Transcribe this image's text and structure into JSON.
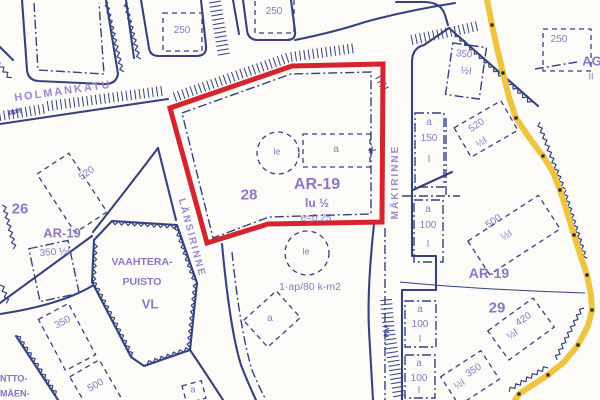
{
  "map": {
    "description": "Finnish detail-plan (asemakaava) map excerpt with a red-outlined plot",
    "colors": {
      "line_blue": "#35427f",
      "label_violet": "#8a79c5",
      "red_boundary": "#d5242d",
      "yellow_line": "#efc53f",
      "background": "#fcfbf8"
    },
    "highlighted_plot": {
      "zone_code": "AR-19",
      "plot_number": "28",
      "storeys": "lu ½",
      "efficiency": "e=0.25"
    }
  },
  "labels": [
    {
      "name": "street-holmankatu",
      "text": "HOLMANKATU",
      "x": 63,
      "y": 92,
      "size": 11,
      "rot": -8,
      "cls": "street"
    },
    {
      "name": "strip-ppt-left",
      "text": "pp/t",
      "x": 15,
      "y": 112,
      "size": 7,
      "rot": -8,
      "cls": "strip"
    },
    {
      "name": "num-250-topleft",
      "text": "250",
      "x": 182,
      "y": 31,
      "size": 10,
      "rot": 0,
      "cls": ""
    },
    {
      "name": "num-250-topcenter",
      "text": "250",
      "x": 274,
      "y": 12,
      "size": 10,
      "rot": 0,
      "cls": ""
    },
    {
      "name": "num-250-topright",
      "text": "250",
      "x": 559,
      "y": 40,
      "size": 10,
      "rot": 0,
      "cls": ""
    },
    {
      "name": "zone-ag",
      "text": "AG",
      "x": 592,
      "y": 61,
      "size": 13,
      "rot": 0,
      "cls": "zone"
    },
    {
      "name": "zone-ag-ii",
      "text": "II",
      "x": 591,
      "y": 77,
      "size": 9,
      "rot": 0,
      "cls": ""
    },
    {
      "name": "num-350-topright",
      "text": "350",
      "x": 464,
      "y": 55,
      "size": 10,
      "rot": 6,
      "cls": ""
    },
    {
      "name": "num-350-topright-half",
      "text": "½I",
      "x": 466,
      "y": 72,
      "size": 10,
      "rot": 6,
      "cls": ""
    },
    {
      "name": "num-520-right",
      "text": "520",
      "x": 477,
      "y": 126,
      "size": 10,
      "rot": -34,
      "cls": ""
    },
    {
      "name": "num-520-right-half",
      "text": "½I",
      "x": 482,
      "y": 143,
      "size": 10,
      "rot": -34,
      "cls": ""
    },
    {
      "name": "box-a150-a",
      "text": "a",
      "x": 429,
      "y": 123,
      "size": 10,
      "rot": 0,
      "cls": ""
    },
    {
      "name": "box-a150-num",
      "text": "150",
      "x": 429,
      "y": 139,
      "size": 10,
      "rot": 0,
      "cls": ""
    },
    {
      "name": "box-a150-i",
      "text": "I",
      "x": 429,
      "y": 160,
      "size": 10,
      "rot": 0,
      "cls": ""
    },
    {
      "name": "box-a100a-a",
      "text": "a",
      "x": 428,
      "y": 210,
      "size": 10,
      "rot": 0,
      "cls": ""
    },
    {
      "name": "box-a100a-num",
      "text": "100",
      "x": 428,
      "y": 226,
      "size": 10,
      "rot": 0,
      "cls": ""
    },
    {
      "name": "box-a100a-i",
      "text": "I",
      "x": 428,
      "y": 245,
      "size": 10,
      "rot": 0,
      "cls": ""
    },
    {
      "name": "box-a100b-a",
      "text": "a",
      "x": 420,
      "y": 310,
      "size": 10,
      "rot": 0,
      "cls": ""
    },
    {
      "name": "box-a100b-num",
      "text": "100",
      "x": 420,
      "y": 325,
      "size": 10,
      "rot": 0,
      "cls": ""
    },
    {
      "name": "box-a100b-i",
      "text": "I",
      "x": 420,
      "y": 340,
      "size": 10,
      "rot": 0,
      "cls": ""
    },
    {
      "name": "box-a100c-a",
      "text": "a",
      "x": 419,
      "y": 364,
      "size": 10,
      "rot": 0,
      "cls": ""
    },
    {
      "name": "box-a100c-num",
      "text": "100",
      "x": 419,
      "y": 379,
      "size": 10,
      "rot": 0,
      "cls": ""
    },
    {
      "name": "box-a100c-i",
      "text": "I",
      "x": 419,
      "y": 391,
      "size": 10,
      "rot": 0,
      "cls": ""
    },
    {
      "name": "num-500-right",
      "text": "500",
      "x": 494,
      "y": 222,
      "size": 10,
      "rot": -33,
      "cls": ""
    },
    {
      "name": "num-500-right-half",
      "text": "½I",
      "x": 507,
      "y": 236,
      "size": 10,
      "rot": -33,
      "cls": ""
    },
    {
      "name": "zone-ar19-right",
      "text": "AR-19",
      "x": 489,
      "y": 273,
      "size": 14,
      "rot": 0,
      "cls": "zone"
    },
    {
      "name": "plot-29",
      "text": "29",
      "x": 497,
      "y": 308,
      "size": 15,
      "rot": 0,
      "cls": "zone"
    },
    {
      "name": "num-420",
      "text": "420",
      "x": 524,
      "y": 320,
      "size": 10,
      "rot": -35,
      "cls": ""
    },
    {
      "name": "num-420-half",
      "text": "½I",
      "x": 513,
      "y": 335,
      "size": 10,
      "rot": -35,
      "cls": ""
    },
    {
      "name": "num-350-botright",
      "text": "350",
      "x": 474,
      "y": 371,
      "size": 10,
      "rot": -33,
      "cls": ""
    },
    {
      "name": "num-350-botright-half",
      "text": "½I",
      "x": 460,
      "y": 385,
      "size": 10,
      "rot": -33,
      "cls": ""
    },
    {
      "name": "street-makirinne",
      "text": "MÄKIRINNE",
      "x": 396,
      "y": 182,
      "size": 10,
      "rot": -90,
      "cls": "street"
    },
    {
      "name": "street-lansirinne",
      "text": "LÄNSIRINNE",
      "x": 191,
      "y": 238,
      "size": 10,
      "rot": 75,
      "cls": "street"
    },
    {
      "name": "zone-ar19-red",
      "text": "AR-19",
      "x": 317,
      "y": 185,
      "size": 16,
      "rot": 0,
      "cls": "zone"
    },
    {
      "name": "storeys-lu",
      "text": "lu  ½",
      "x": 317,
      "y": 203,
      "size": 12,
      "rot": 0,
      "cls": "zone"
    },
    {
      "name": "efficiency",
      "text": "e=0.25",
      "x": 316,
      "y": 219,
      "size": 10,
      "rot": 0,
      "cls": ""
    },
    {
      "name": "plot-28",
      "text": "28",
      "x": 249,
      "y": 195,
      "size": 15,
      "rot": 0,
      "cls": "zone"
    },
    {
      "name": "le-red-parcel",
      "text": "le",
      "x": 277,
      "y": 152,
      "size": 9,
      "rot": 0,
      "cls": ""
    },
    {
      "name": "a-red-parcel",
      "text": "a",
      "x": 336,
      "y": 150,
      "size": 10,
      "rot": 0,
      "cls": ""
    },
    {
      "name": "le-lower-parcel",
      "text": "le",
      "x": 306,
      "y": 252,
      "size": 9,
      "rot": 0,
      "cls": ""
    },
    {
      "name": "apartment-rule",
      "text": "1·ap/80 k-m2",
      "x": 310,
      "y": 287,
      "size": 10.5,
      "rot": 0,
      "cls": ""
    },
    {
      "name": "a-lower-parcel",
      "text": "a",
      "x": 270,
      "y": 319,
      "size": 10,
      "rot": -8,
      "cls": ""
    },
    {
      "name": "strip-ppt-right",
      "text": "pp/t",
      "x": 387,
      "y": 331,
      "size": 7,
      "rot": -78,
      "cls": "strip"
    },
    {
      "name": "plot-26",
      "text": "26",
      "x": 20,
      "y": 209,
      "size": 15,
      "rot": 0,
      "cls": "zone"
    },
    {
      "name": "zone-ar19-left",
      "text": "AR-19",
      "x": 62,
      "y": 233,
      "size": 13,
      "rot": 0,
      "cls": "zone"
    },
    {
      "name": "num-350-left",
      "text": "350  ½I",
      "x": 55,
      "y": 253,
      "size": 10,
      "rot": -4,
      "cls": ""
    },
    {
      "name": "num-520-left",
      "text": "520",
      "x": 87,
      "y": 174,
      "size": 10,
      "rot": -35,
      "cls": ""
    },
    {
      "name": "park-name-1",
      "text": "VAAHTERA-",
      "x": 142,
      "y": 262,
      "size": 10.5,
      "rot": 0,
      "cls": "zone"
    },
    {
      "name": "park-name-2",
      "text": "PUISTO",
      "x": 142,
      "y": 282,
      "size": 10.5,
      "rot": 0,
      "cls": "zone"
    },
    {
      "name": "park-code-vl",
      "text": "VL",
      "x": 150,
      "y": 304,
      "size": 13,
      "rot": 0,
      "cls": "zone"
    },
    {
      "name": "num-350-botleft",
      "text": "350",
      "x": 63,
      "y": 323,
      "size": 10,
      "rot": -28,
      "cls": ""
    },
    {
      "name": "num-500-botleft",
      "text": "500",
      "x": 96,
      "y": 386,
      "size": 10,
      "rot": -30,
      "cls": ""
    },
    {
      "name": "edge-ntto",
      "text": "NTTO-",
      "x": 0,
      "y": 379,
      "size": 9,
      "rot": 0,
      "cls": "edge"
    },
    {
      "name": "edge-maen",
      "text": "MÄEN-",
      "x": 0,
      "y": 394,
      "size": 9,
      "rot": 0,
      "cls": "edge"
    },
    {
      "name": "a-bottom-small",
      "text": "a",
      "x": 193,
      "y": 390,
      "size": 9,
      "rot": 0,
      "cls": ""
    }
  ]
}
